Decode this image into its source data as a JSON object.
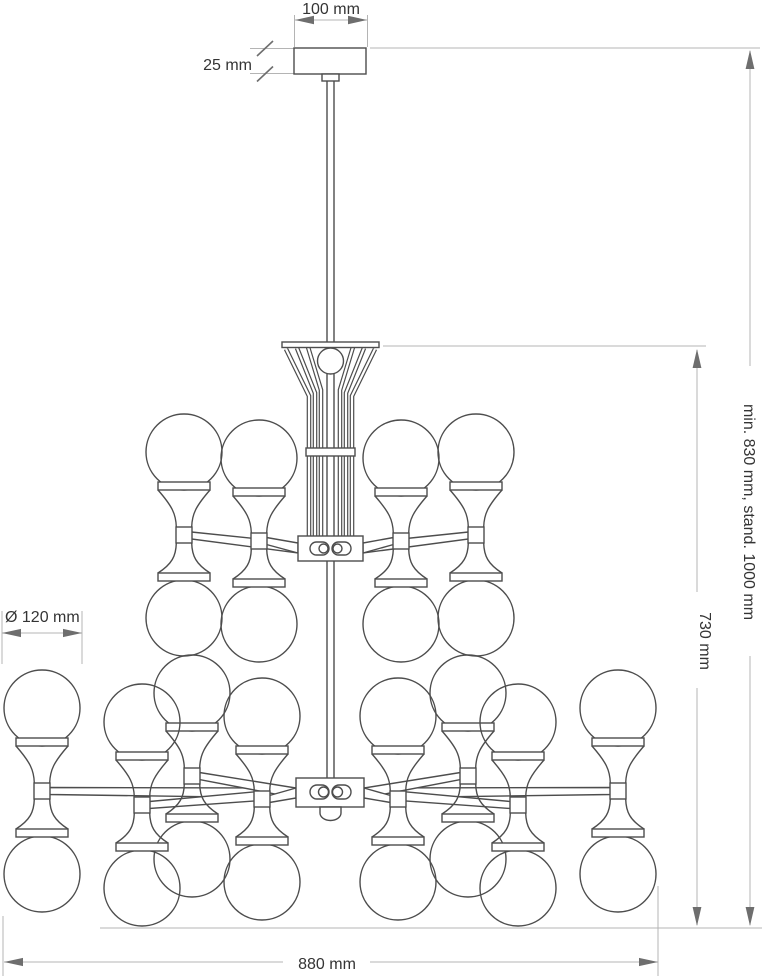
{
  "drawing": {
    "type": "technical dimension drawing",
    "subject": "two-tier glass globe chandelier, front elevation",
    "dimensions": {
      "canopy_width": "100 mm",
      "canopy_height": "25 mm",
      "globe_diameter": "Ø 120 mm",
      "body_height": "730 mm",
      "total_height": "min. 830 mm, stand. 1000 mm",
      "body_width": "880 mm"
    },
    "counts": {
      "upper_tier_globe_units": 4,
      "lower_tier_globe_units": 8
    },
    "colors": {
      "background": "#ffffff",
      "outline": "#4d4d4d",
      "dimension_line": "#b4b4b4",
      "arrow": "#6e6e6e",
      "text": "#343434"
    }
  }
}
